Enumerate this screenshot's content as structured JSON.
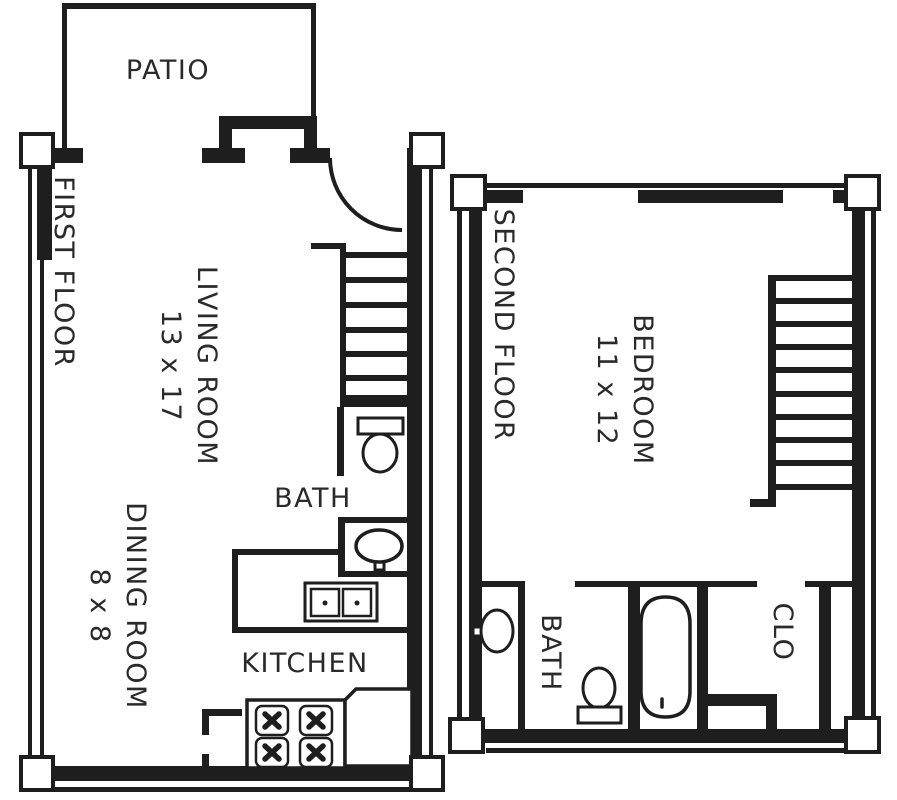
{
  "plan": {
    "title": "Townhouse floor plan",
    "colors": {
      "line": "#1e1e1e",
      "text": "#2a2a2a",
      "background": "#ffffff"
    },
    "first_floor": {
      "label": "FIRST FLOOR",
      "patio": {
        "label": "PATIO"
      },
      "living_room": {
        "name": "LIVING ROOM",
        "dims": "13 x 17"
      },
      "dining_room": {
        "name": "DINING ROOM",
        "dims": "8 x 8"
      },
      "bath": {
        "label": "BATH"
      },
      "kitchen": {
        "label": "KITCHEN"
      }
    },
    "second_floor": {
      "label": "SECOND FLOOR",
      "bedroom": {
        "name": "BEDROOM",
        "dims": "11 x 12"
      },
      "bath": {
        "label": "BATH"
      },
      "closet": {
        "label": "CLO"
      }
    }
  }
}
